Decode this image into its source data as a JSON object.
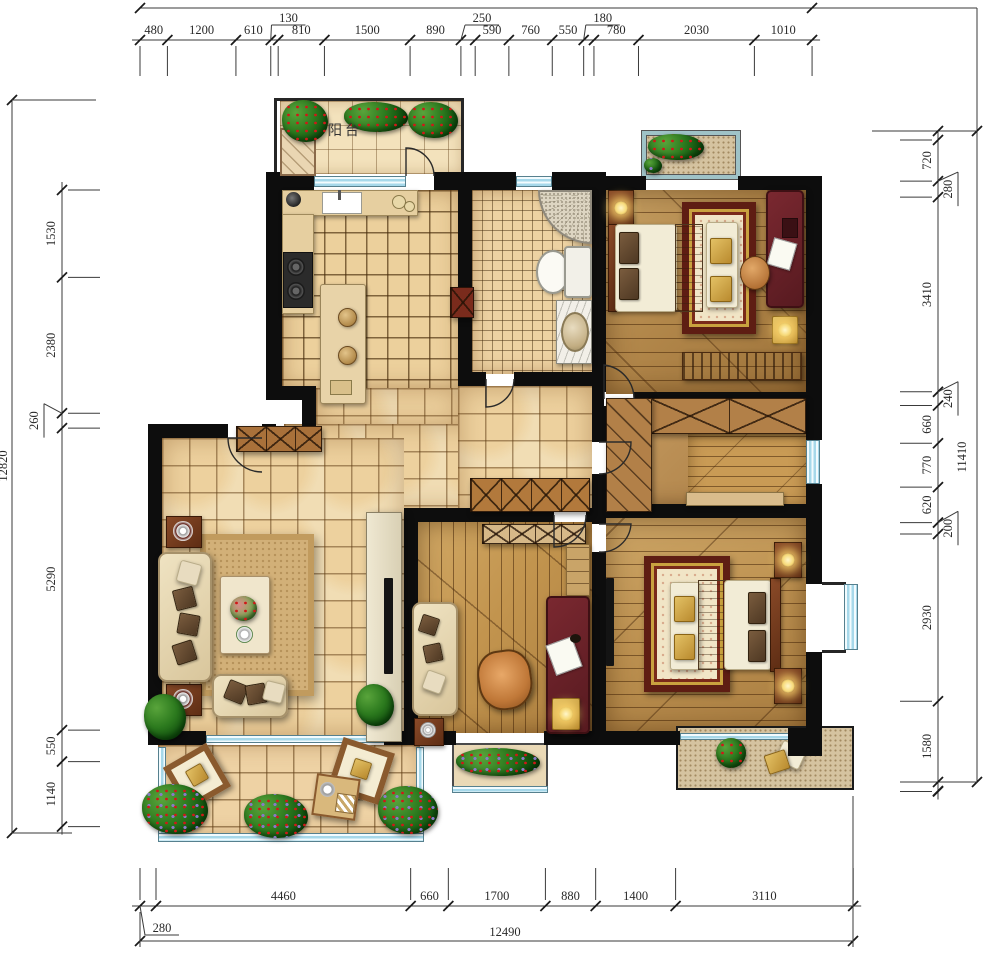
{
  "plan": {
    "balcony_label": "阳台"
  },
  "dimensions": {
    "top": [
      {
        "v": "480"
      },
      {
        "v": "1200"
      },
      {
        "v": "610"
      },
      {
        "v": "130",
        "r": 1
      },
      {
        "v": "810"
      },
      {
        "v": "1500"
      },
      {
        "v": "890"
      },
      {
        "v": "250",
        "r": 1
      },
      {
        "v": "590"
      },
      {
        "v": "760"
      },
      {
        "v": "550"
      },
      {
        "v": "180",
        "r": 1
      },
      {
        "v": "780"
      },
      {
        "v": "2030"
      },
      {
        "v": "1010"
      }
    ],
    "bottom": [
      {
        "v": "280",
        "r": 1
      },
      {
        "v": "4460"
      },
      {
        "v": "660"
      },
      {
        "v": "1700"
      },
      {
        "v": "880"
      },
      {
        "v": "1400"
      },
      {
        "v": "3110"
      }
    ],
    "left": [
      {
        "v": "1530"
      },
      {
        "v": "2380"
      },
      {
        "v": "260",
        "r": 1
      },
      {
        "v": "5290"
      },
      {
        "v": "550"
      },
      {
        "v": "1140"
      }
    ],
    "right": [
      {
        "v": "720"
      },
      {
        "v": "280",
        "r": 1
      },
      {
        "v": "3410"
      },
      {
        "v": "240",
        "r": 1
      },
      {
        "v": "660"
      },
      {
        "v": "770"
      },
      {
        "v": "620"
      },
      {
        "v": "200",
        "r": 1
      },
      {
        "v": "2930"
      },
      {
        "v": "1580"
      }
    ],
    "totals": {
      "left": "12820",
      "right": "11410",
      "bottom": "12490"
    }
  },
  "colors": {
    "wall": "#0d0d0d",
    "window": "#a6d8ea",
    "dim_text": "#2a2a2a",
    "tile": "#f1ddb4",
    "wood": "#b2874a"
  }
}
